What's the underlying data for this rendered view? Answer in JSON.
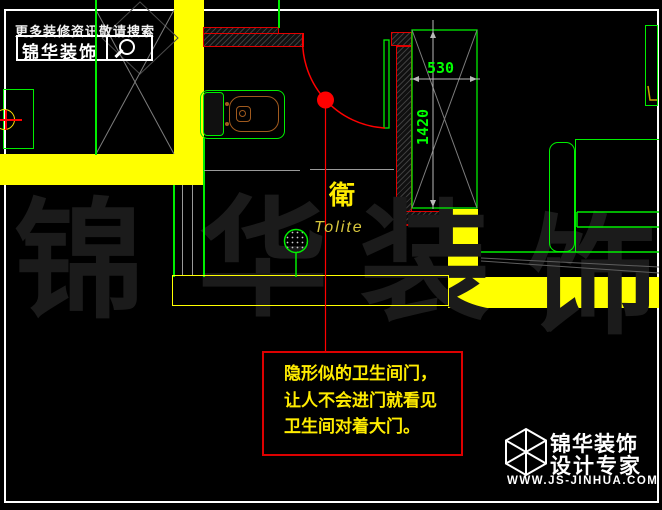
{
  "header": {
    "search_hint": "更多装修资讯敬请搜索",
    "brand": "锦华装饰",
    "search_icon": "magnifier-icon"
  },
  "plan": {
    "room_label_cn": "衛",
    "room_label_en": "Tolite",
    "dim_width": "530",
    "dim_height": "1420"
  },
  "annotation": {
    "line1": "隐形似的卫生间门，",
    "line2": "让人不会进门就看见",
    "line3": "卫生间对着大门。"
  },
  "watermark": {
    "char1": "锦",
    "char2": "华",
    "char3": "装",
    "char4": "饰"
  },
  "footer": {
    "brand": "锦华装饰",
    "tagline": "设计专家",
    "website": "WWW.JS-JINHUA.COM"
  },
  "colors": {
    "wall_yellow": "#ffff00",
    "line_green": "#00ee00",
    "marker_red": "#ff0000",
    "text_yellow": "#ffec00",
    "frame_white": "#ffffff"
  }
}
